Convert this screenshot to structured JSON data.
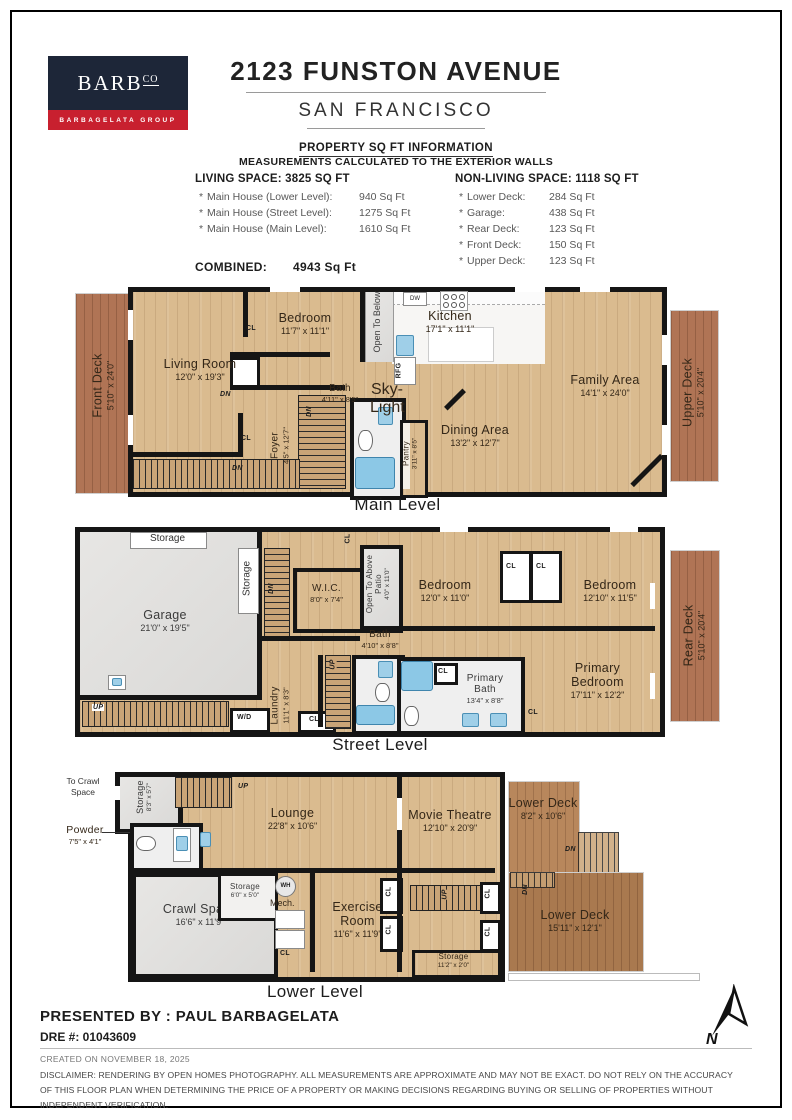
{
  "colors": {
    "navy": "#1d2638",
    "red": "#c8202f",
    "wood": "#dabb8f",
    "deck": "#b07455"
  },
  "header": {
    "logo_text": "BARB",
    "logo_sup": "CO",
    "logo_tagline": "BARBAGELATA GROUP",
    "title": "2123 FUNSTON AVENUE",
    "subtitle": "SAN FRANCISCO"
  },
  "sqft": {
    "heading": "PROPERTY SQ FT INFORMATION",
    "subheading": "MEASUREMENTS CALCULATED TO THE EXTERIOR WALLS",
    "living_heading": "LIVING SPACE: 3825 SQ FT",
    "living_items": [
      {
        "bullet": "*",
        "name": "Main House (Lower Level):",
        "value": "940 Sq Ft"
      },
      {
        "bullet": "*",
        "name": "Main House (Street Level):",
        "value": "1275 Sq Ft"
      },
      {
        "bullet": "*",
        "name": "Main House (Main Level):",
        "value": "1610 Sq Ft"
      }
    ],
    "nonliving_heading": "NON-LIVING SPACE: 1118 SQ FT",
    "nonliving_items": [
      {
        "bullet": "*",
        "name": "Lower Deck:",
        "value": "284 Sq Ft"
      },
      {
        "bullet": "*",
        "name": "Garage:",
        "value": "438 Sq Ft"
      },
      {
        "bullet": "*",
        "name": "Rear Deck:",
        "value": "123 Sq Ft"
      },
      {
        "bullet": "*",
        "name": "Front Deck:",
        "value": "150 Sq Ft"
      },
      {
        "bullet": "*",
        "name": "Upper Deck:",
        "value": "123 Sq Ft"
      }
    ],
    "combined_label": "COMBINED:",
    "combined_value": "4943  Sq Ft"
  },
  "tags": {
    "cl": "CL",
    "dn": "DN",
    "up": "UP",
    "wd": "W/D",
    "dw": "DW",
    "rfg": "RFG",
    "wh": "WH",
    "mech": "Mech."
  },
  "main_level": {
    "caption": "Main Level",
    "front_deck": {
      "name": "Front Deck",
      "dims": "5'10\" x 24'0\""
    },
    "upper_deck": {
      "name": "Upper Deck",
      "dims": "5'10\" x 20'4\""
    },
    "living": {
      "name": "Living Room",
      "dims": "12'0\" x 19'3\""
    },
    "bedroom": {
      "name": "Bedroom",
      "dims": "11'7\" x 11'1\""
    },
    "kitchen": {
      "name": "Kitchen",
      "dims": "17'1\" x 11'1\""
    },
    "family": {
      "name": "Family Area",
      "dims": "14'1\" x 24'0\""
    },
    "dining": {
      "name": "Dining Area",
      "dims": "13'2\" x 12'7\""
    },
    "bath": {
      "name": "Bath",
      "dims": "4'11\" x 8'5\""
    },
    "foyer": {
      "name": "Foyer",
      "dims": "4'5\" x 12'7\""
    },
    "pantry": {
      "name": "Pantry",
      "dims": "3'11\" x 8'5\""
    },
    "open_below": "Open To Below",
    "skylight": "Sky-Light"
  },
  "street_level": {
    "caption": "Street Level",
    "garage": {
      "name": "Garage",
      "dims": "21'0\" x 19'5\""
    },
    "storage_top": "Storage",
    "storage_side": "Storage",
    "wic": {
      "name": "W.I.C.",
      "dims": "8'0\" x 7'4\""
    },
    "patio": {
      "name": "Open To Above Patio",
      "dims": "4'0\" x 11'0\""
    },
    "bedroom1": {
      "name": "Bedroom",
      "dims": "12'0\" x 11'0\""
    },
    "bedroom2": {
      "name": "Bedroom",
      "dims": "12'10\" x 11'5\""
    },
    "bath": {
      "name": "Bath",
      "dims": "4'10\" x 8'8\""
    },
    "primary_bath": {
      "name": "Primary Bath",
      "dims": "13'4\" x 8'8\""
    },
    "primary_bedroom": {
      "name": "Primary Bedroom",
      "dims": "17'11\" x 12'2\""
    },
    "laundry": {
      "name": "Laundry",
      "dims": "11'1\" x 8'3\""
    },
    "rear_deck": {
      "name": "Rear Deck",
      "dims": "5'10\" x 20'4\""
    }
  },
  "lower_level": {
    "caption": "Lower Level",
    "to_crawl": "To Crawl Space",
    "storage_side": {
      "name": "Storage",
      "dims": "8'3\" x 5'7\""
    },
    "powder": {
      "name": "Powder",
      "dims": "7'5\" x 4'1\""
    },
    "lounge": {
      "name": "Lounge",
      "dims": "22'8\" x 10'6\""
    },
    "crawl": {
      "name": "Crawl Space",
      "dims": "16'6\" x 11'9\""
    },
    "storage_small": {
      "name": "Storage",
      "dims": "6'0\" x 5'0\""
    },
    "exercise": {
      "name": "Exercise Room",
      "dims": "11'6\" x 11'9\""
    },
    "movie": {
      "name": "Movie Theatre",
      "dims": "12'10\" x 20'9\""
    },
    "storage_bottom": {
      "name": "Storage",
      "dims": "11'2\" x 2'0\""
    },
    "deck1": {
      "name": "Lower Deck",
      "dims": "8'2\" x 10'6\""
    },
    "deck2": {
      "name": "Lower Deck",
      "dims": "15'11\" x 12'1\""
    }
  },
  "footer": {
    "presented_by": "PRESENTED BY : PAUL BARBAGELATA",
    "dre": "DRE #: 01043609",
    "created": "CREATED ON NOVEMBER 18, 2025",
    "disclaimer": "DISCLAIMER: RENDERING BY OPEN HOMES PHOTOGRAPHY. ALL MEASUREMENTS ARE APPROXIMATE AND MAY NOT BE EXACT. DO NOT RELY ON THE ACCURACY OF THIS FLOOR PLAN WHEN DETERMINING THE PRICE OF A PROPERTY OR MAKING DECISIONS REGARDING BUYING OR SELLING OF PROPERTIES WITHOUT INDEPENDENT VERIFICATION.",
    "compass": "N"
  }
}
